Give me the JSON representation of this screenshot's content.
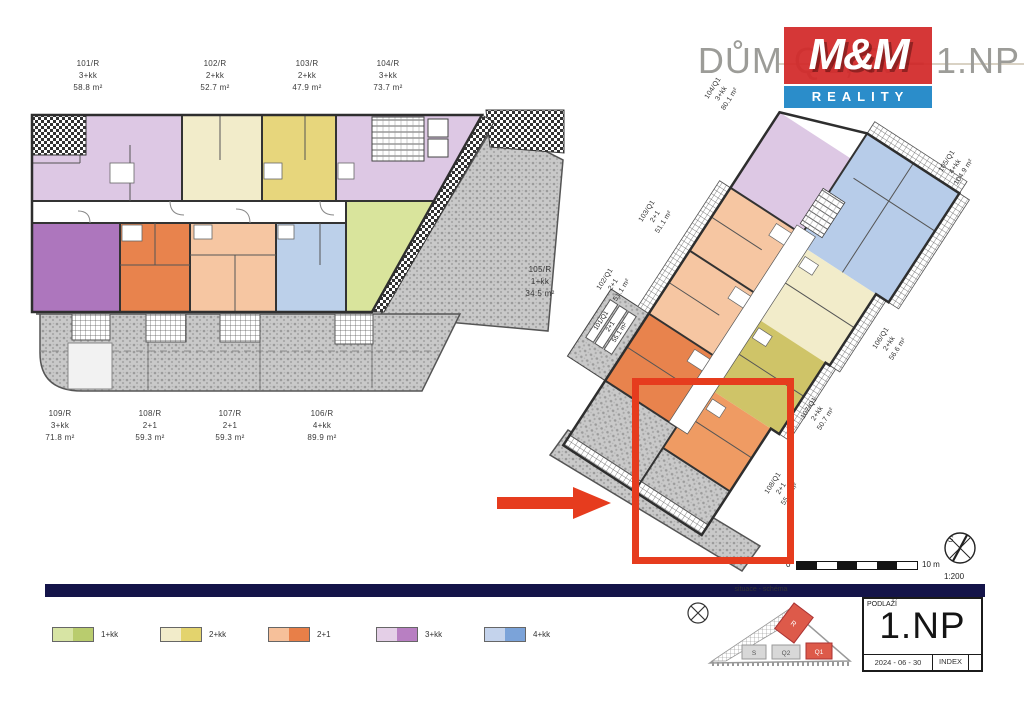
{
  "header": {
    "title": "DŮM Q1, R – 1.NP",
    "logo_top": "M&M",
    "logo_bottom": "REALITY"
  },
  "left_plan": {
    "labels_top": [
      {
        "unit": "101/R",
        "type": "3+kk",
        "area": "58.8 m²"
      },
      {
        "unit": "102/R",
        "type": "2+kk",
        "area": "52.7 m²"
      },
      {
        "unit": "103/R",
        "type": "2+kk",
        "area": "47.9 m²"
      },
      {
        "unit": "104/R",
        "type": "3+kk",
        "area": "73.7 m²"
      }
    ],
    "labels_bottom": [
      {
        "unit": "109/R",
        "type": "3+kk",
        "area": "71.8 m²"
      },
      {
        "unit": "108/R",
        "type": "2+1",
        "area": "59.3 m²"
      },
      {
        "unit": "107/R",
        "type": "2+1",
        "area": "59.3 m²"
      },
      {
        "unit": "106/R",
        "type": "4+kk",
        "area": "89.9 m²"
      }
    ],
    "label_right": {
      "unit": "105/R",
      "type": "1+kk",
      "area": "34.5 m²"
    }
  },
  "right_plan": {
    "labels": {
      "l104": {
        "unit": "104/Q1",
        "type": "3+kk",
        "area": "80.1 m²"
      },
      "l103": {
        "unit": "103/Q1",
        "type": "2+1",
        "area": "51.1 m²"
      },
      "l102": {
        "unit": "102/Q1",
        "type": "2+1",
        "area": "51.1 m²"
      },
      "l105": {
        "unit": "105/Q1",
        "type": "4+kk",
        "area": "104.9 m²"
      },
      "l106": {
        "unit": "106/Q1",
        "type": "2+kk",
        "area": "56.6 m²"
      },
      "l107": {
        "unit": "107/Q1",
        "type": "2+kk",
        "area": "50.7 m²"
      },
      "l108": {
        "unit": "108/Q1",
        "type": "2+1",
        "area": "55.4 m²"
      }
    },
    "label_terrace": {
      "unit": "101/Q1",
      "type": "2+1",
      "area": "55.1 m²"
    }
  },
  "legend": {
    "items": [
      {
        "label": "1+kk",
        "light": "#d7e4a4",
        "dark": "#b9cc6e"
      },
      {
        "label": "2+kk",
        "light": "#f2ecca",
        "dark": "#e3d36d"
      },
      {
        "label": "2+1",
        "light": "#f6c09a",
        "dark": "#e87f48"
      },
      {
        "label": "3+kk",
        "light": "#e4cfe7",
        "dark": "#b87fc2"
      },
      {
        "label": "4+kk",
        "light": "#c4d3ec",
        "dark": "#7ba3d9"
      }
    ]
  },
  "scalebar": {
    "zero": "0",
    "max": "10 m",
    "ratio": "1:200",
    "north": "S"
  },
  "schema": {
    "title": "situace - schéma",
    "buildings": {
      "s": "S",
      "q2": "Q2",
      "q1": "Q1",
      "r": "R"
    }
  },
  "title_block": {
    "floor_label": "PODLAŽÍ",
    "floor": "1.NP",
    "date": "2024 - 06 - 30",
    "index": "INDEX"
  },
  "colors": {
    "accent_red": "#e63c1e",
    "logo_red": "#d32b2b",
    "logo_blue": "#1e86c7",
    "navy": "#141449"
  }
}
